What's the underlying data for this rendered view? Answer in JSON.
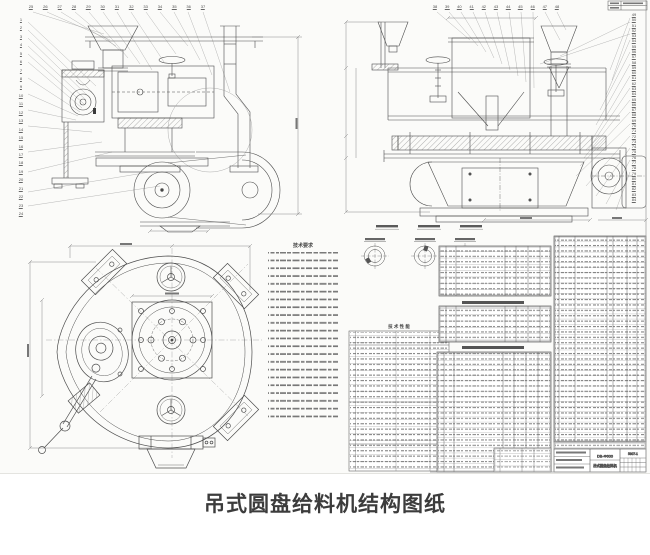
{
  "page": {
    "caption": "吊式圆盘给料机结构图纸"
  },
  "drawing": {
    "notes": {
      "title": "技术要求"
    },
    "spec_table": {
      "title": "技 术 性 能"
    },
    "title_block": {
      "model": "DB-Φ600",
      "name": "吊式圆盘给料机",
      "drawing_no": "5307-1"
    },
    "callouts": {
      "view1_left": [
        "1",
        "2",
        "3",
        "4",
        "5",
        "6",
        "7",
        "8",
        "9",
        "10",
        "11",
        "12",
        "13",
        "14",
        "15",
        "16",
        "17",
        "18",
        "19",
        "20",
        "21",
        "22",
        "23",
        "24"
      ],
      "view1_top": [
        "25",
        "26",
        "27",
        "28",
        "29",
        "30",
        "31",
        "32",
        "33",
        "34",
        "35",
        "36",
        "37"
      ],
      "view2_top": [
        "38",
        "39",
        "40",
        "41",
        "42",
        "43",
        "44",
        "45",
        "46",
        "47",
        "48"
      ],
      "view2_right": [
        "49",
        "50",
        "51",
        "52",
        "53",
        "54",
        "55",
        "56",
        "57",
        "58",
        "59",
        "60",
        "61",
        "62",
        "63",
        "64",
        "65",
        "66",
        "67",
        "68",
        "69",
        "70",
        "71",
        "72",
        "73",
        "74",
        "75",
        "76",
        "77",
        "78",
        "79",
        "80",
        "81",
        "82",
        "83",
        "84"
      ]
    }
  }
}
